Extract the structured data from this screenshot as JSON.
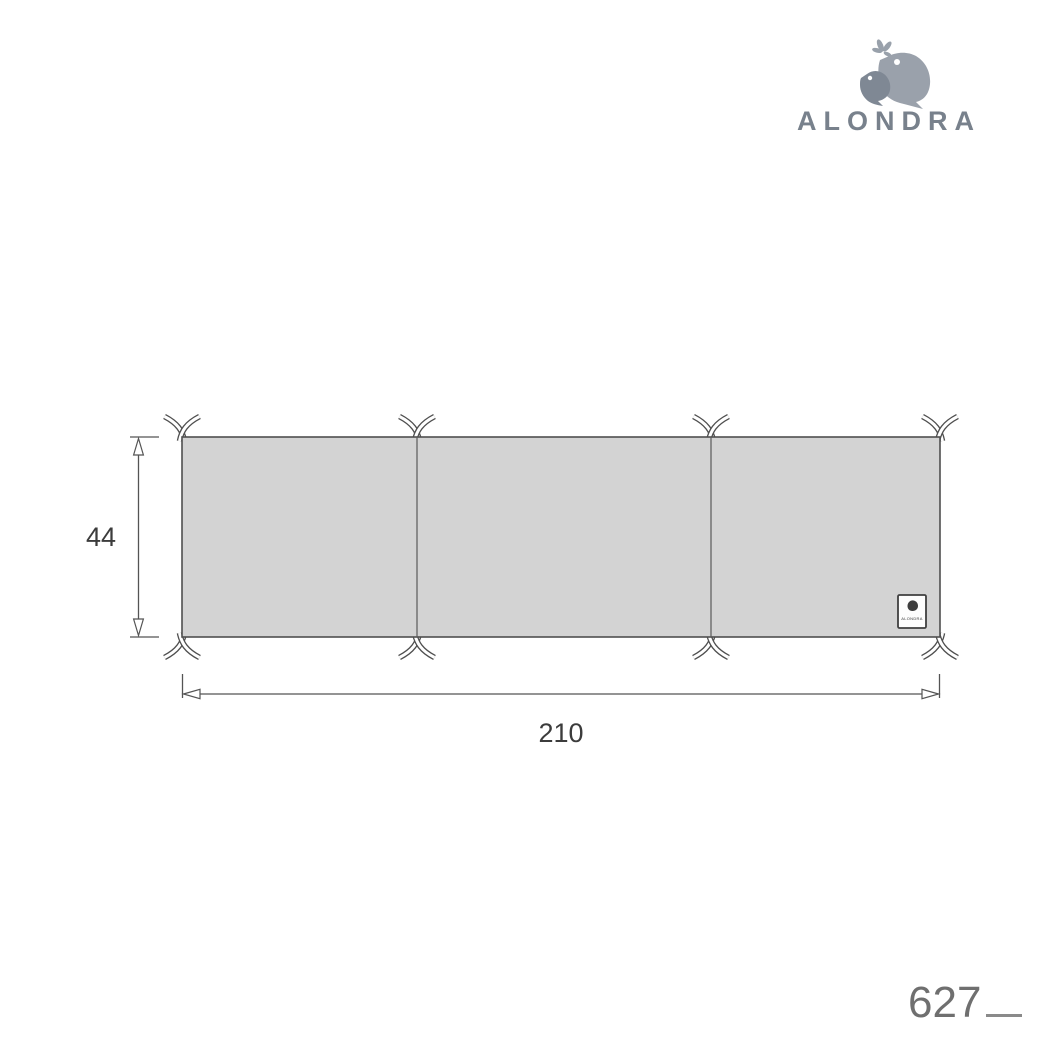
{
  "brand": {
    "name": "ALONDRA"
  },
  "diagram": {
    "type": "product-technical-drawing",
    "subject": "cot-bumper-three-panels-with-ties",
    "panels": 3,
    "ties": 8,
    "dimensions": {
      "width": "210",
      "height": "44"
    },
    "tag_text": "ALONDRA",
    "colors": {
      "panel_fill": "#d3d3d3",
      "outline": "#4f4f4f",
      "dimension_lines": "#545454",
      "label_text": "#3c3c3c",
      "brand_gray": "#78818c",
      "bird_light": "#9aa1ab",
      "bird_dark": "#7f8894",
      "code_gray": "#6f6f6f"
    }
  },
  "icons": {
    "logo": "alondra-two-birds-with-leaves",
    "tie": "fabric-tie-ribbons",
    "tag_bird": "alondra-bird-mini"
  },
  "footer": {
    "product_code": "627"
  }
}
